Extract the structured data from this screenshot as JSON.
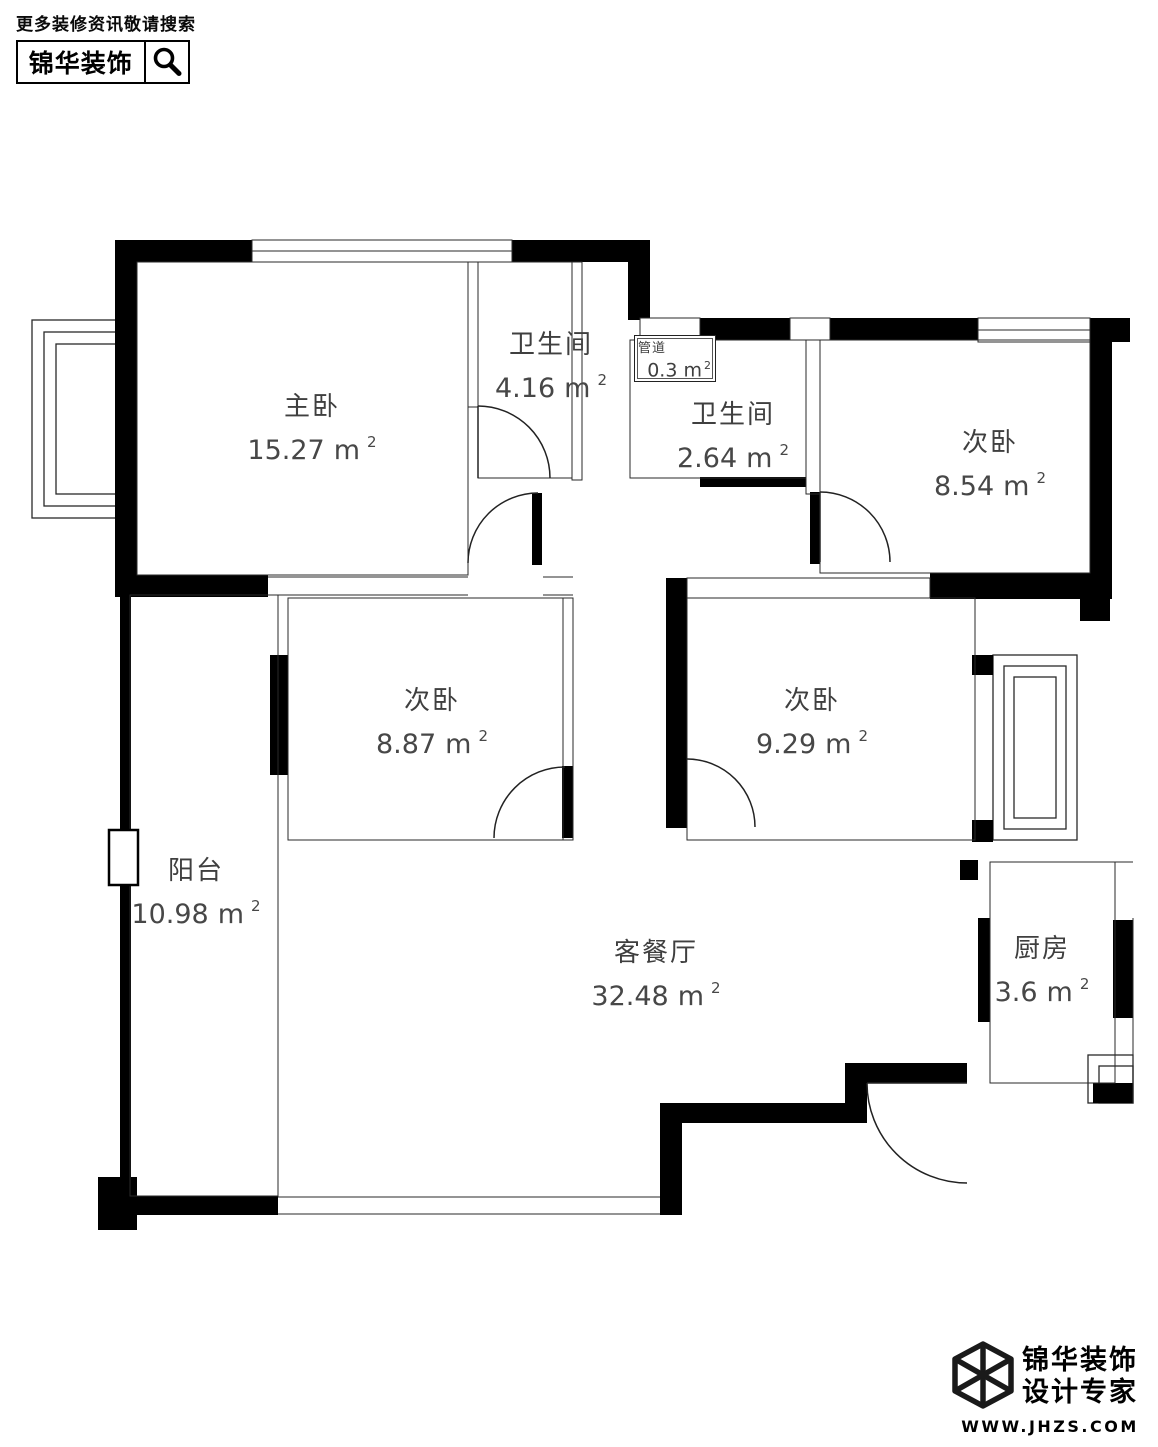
{
  "header": {
    "tagline": "更多装修资讯敬请搜索",
    "brand": "锦华装饰"
  },
  "icons": {
    "search": "magnifier-icon",
    "logo": "cube-logo"
  },
  "plan": {
    "rooms": [
      {
        "name": "主卧",
        "area": "15.27",
        "unit": "m",
        "sup": "2"
      },
      {
        "name": "卫生间",
        "area": "4.16",
        "unit": "m",
        "sup": "2"
      },
      {
        "name": "管道",
        "area": "0.3",
        "unit": "m",
        "sup": "2"
      },
      {
        "name": "卫生间",
        "area": "2.64",
        "unit": "m",
        "sup": "2"
      },
      {
        "name": "次卧",
        "area": "8.54",
        "unit": "m",
        "sup": "2"
      },
      {
        "name": "次卧",
        "area": "8.87",
        "unit": "m",
        "sup": "2"
      },
      {
        "name": "次卧",
        "area": "9.29",
        "unit": "m",
        "sup": "2"
      },
      {
        "name": "阳台",
        "area": "10.98",
        "unit": "m",
        "sup": "2"
      },
      {
        "name": "客餐厅",
        "area": "32.48",
        "unit": "m",
        "sup": "2"
      },
      {
        "name": "厨房",
        "area": "3.6",
        "unit": "m",
        "sup": "2"
      }
    ]
  },
  "footer": {
    "brand_line1": "锦华装饰",
    "brand_line2": "设计专家",
    "website": "WWW.JHZS.COM"
  },
  "colors": {
    "wall": "#000000",
    "line": "#2a2a2a",
    "label": "#3f3f3f"
  }
}
